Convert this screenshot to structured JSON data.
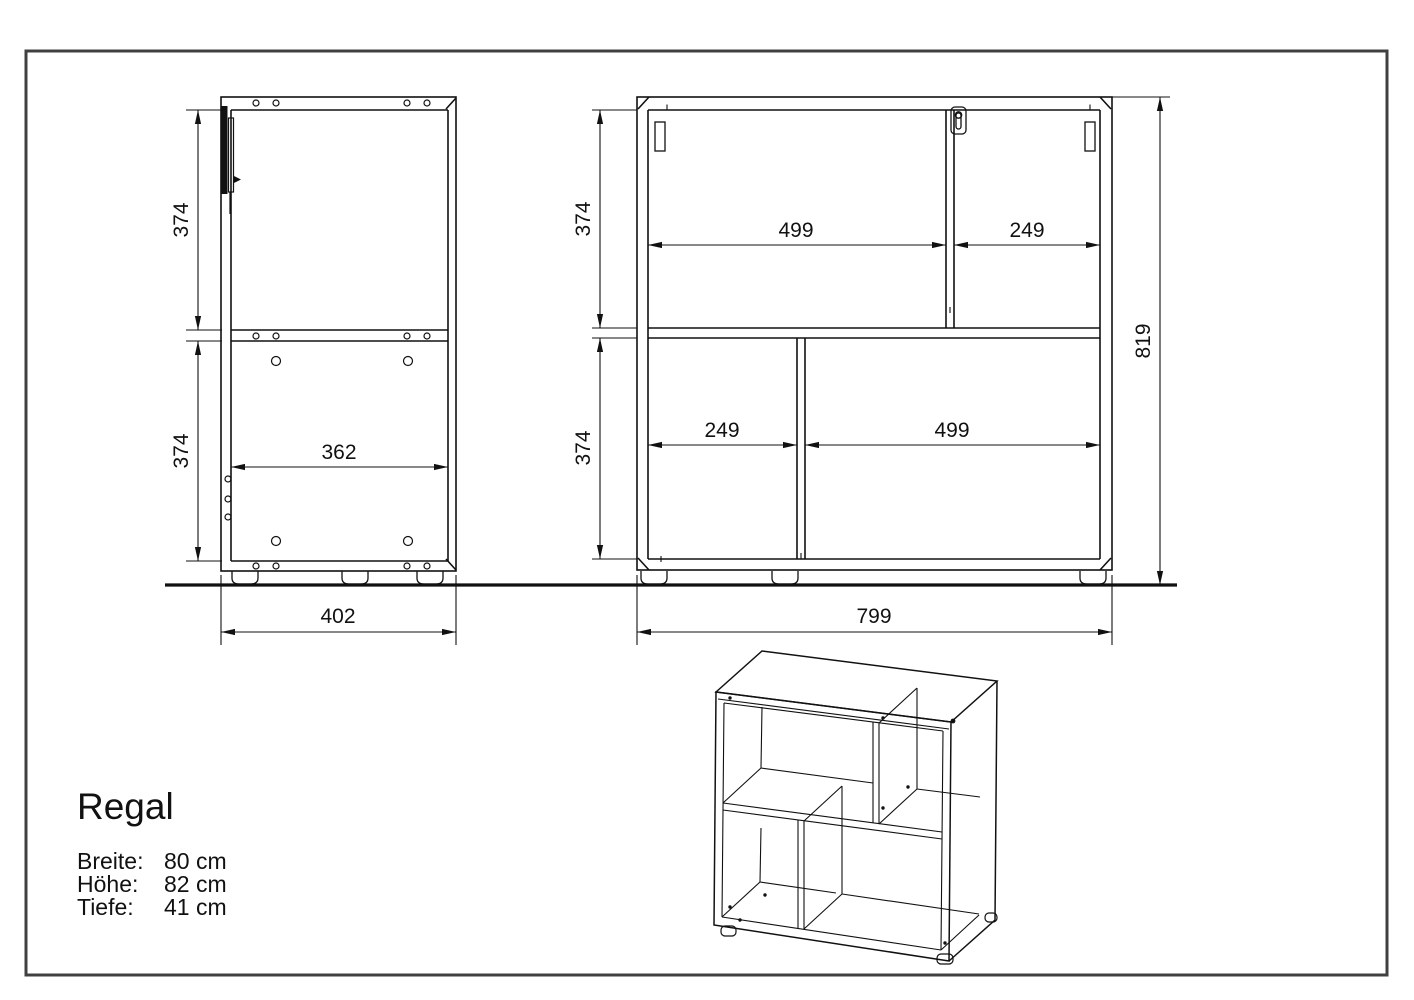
{
  "info": {
    "title": "Regal",
    "specs": [
      {
        "label": "Breite:",
        "value": "80 cm"
      },
      {
        "label": "Höhe:",
        "value": "82 cm"
      },
      {
        "label": "Tiefe:",
        "value": "41 cm"
      }
    ]
  },
  "views": {
    "side_view": {
      "dims": {
        "height_upper": "374",
        "height_lower": "374",
        "depth_inner": "362",
        "depth_total": "402"
      },
      "hardware_icons": [
        "hinge-icon"
      ]
    },
    "front_view": {
      "dims": {
        "height_upper": "374",
        "height_lower": "374",
        "width_top_left": "499",
        "width_top_right": "249",
        "width_bottom_left": "249",
        "width_bottom_right": "499",
        "height_total": "819",
        "width_total": "799"
      },
      "hardware_icons": [
        "fitting-plate-icon",
        "keyhole-fitting-icon",
        "fitting-plate-icon"
      ]
    },
    "isometric_view": {
      "hardware_icons": []
    }
  },
  "colors": {
    "line": "#111111",
    "frame": "#404040",
    "background": "#ffffff"
  }
}
